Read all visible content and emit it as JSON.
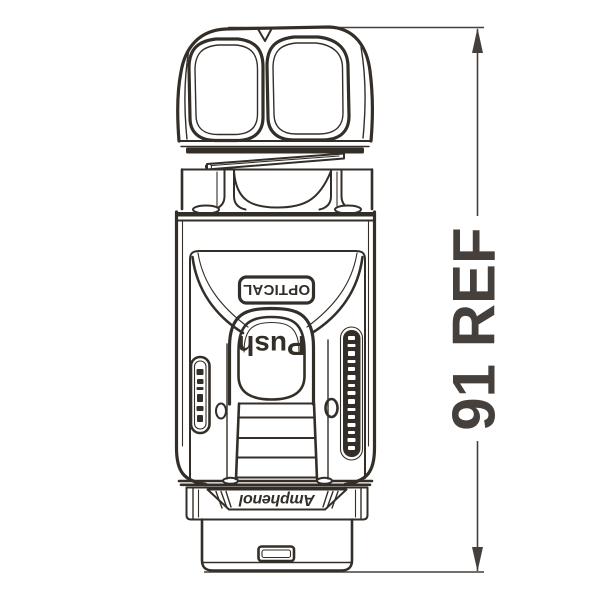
{
  "drawing": {
    "type": "engineering-line-drawing",
    "subject": "Push-pull optical fiber connector, side elevation with overall length dimension",
    "labels": {
      "optical": "OPTICAL",
      "push": "Push",
      "brand": "Amphenol"
    },
    "dimension": {
      "label": "91 REF"
    },
    "colors": {
      "line": "#342e29",
      "dimension": "#45403c",
      "background": "#ffffff"
    }
  }
}
